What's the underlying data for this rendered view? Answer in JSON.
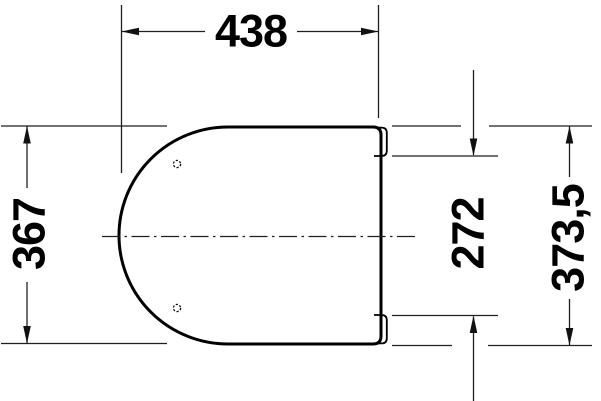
{
  "drawing": {
    "type": "technical-dimension-drawing",
    "view": "seat-top-view",
    "dimensions": {
      "overall_width": "438",
      "side_length": "367",
      "hinge_inner_length": "272",
      "overall_length": "373,5"
    },
    "colors": {
      "background": "#ffffff",
      "outline": "#000000",
      "dimension_lines": "#1f1f1f",
      "text": "#000000"
    }
  }
}
